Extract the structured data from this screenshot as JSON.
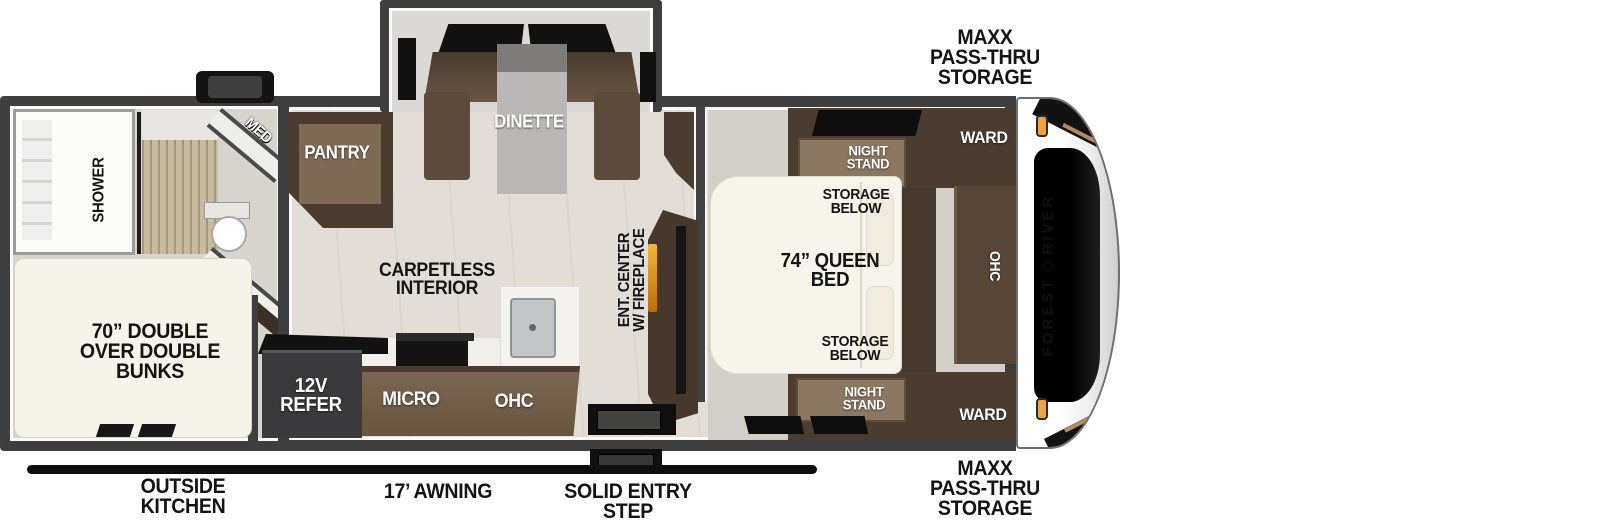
{
  "labels": {
    "maxx_top": "MAXX\nPASS-THRU\nSTORAGE",
    "maxx_bottom": "MAXX\nPASS-THRU\nSTORAGE",
    "outside_kitchen": "OUTSIDE\nKITCHEN",
    "awning": "17’ AWNING",
    "entry_step": "SOLID ENTRY\nSTEP",
    "shower": "SHOWER",
    "med": "MED",
    "pantry": "PANTRY",
    "dinette": "DINETTE",
    "carpetless": "CARPETLESS\nINTERIOR",
    "bunks": "70” DOUBLE\nOVER DOUBLE\nBUNKS",
    "refer": "12V\nREFER",
    "micro": "MICRO",
    "ohc_kitchen": "OHC",
    "ent_center": "ENT. CENTER\nW/ FIREPLACE",
    "queen_bed": "74” QUEEN\nBED",
    "night_stand_top": "NIGHT\nSTAND",
    "night_stand_bottom": "NIGHT\nSTAND",
    "storage_below_top": "STORAGE\nBELOW",
    "storage_below_bottom": "STORAGE\nBELOW",
    "ward_top": "WARD",
    "ward_bottom": "WARD",
    "ohc_bedroom": "OHC"
  },
  "brand": {
    "word1": "FOREST",
    "word2": "RIVER"
  },
  "colors": {
    "wall": "#3e3e3e",
    "cabinet_dark": "#4a3c30",
    "cabinet_mid": "#6b5847",
    "floor_main": "#e2ded7",
    "floor_bedroom": "#d2cfc9",
    "bed_white": "#f7f4eb",
    "marker_orange": "#f2a23a",
    "fireplace_glow": "#f7b535",
    "awning_black": "#0e0e0e"
  }
}
